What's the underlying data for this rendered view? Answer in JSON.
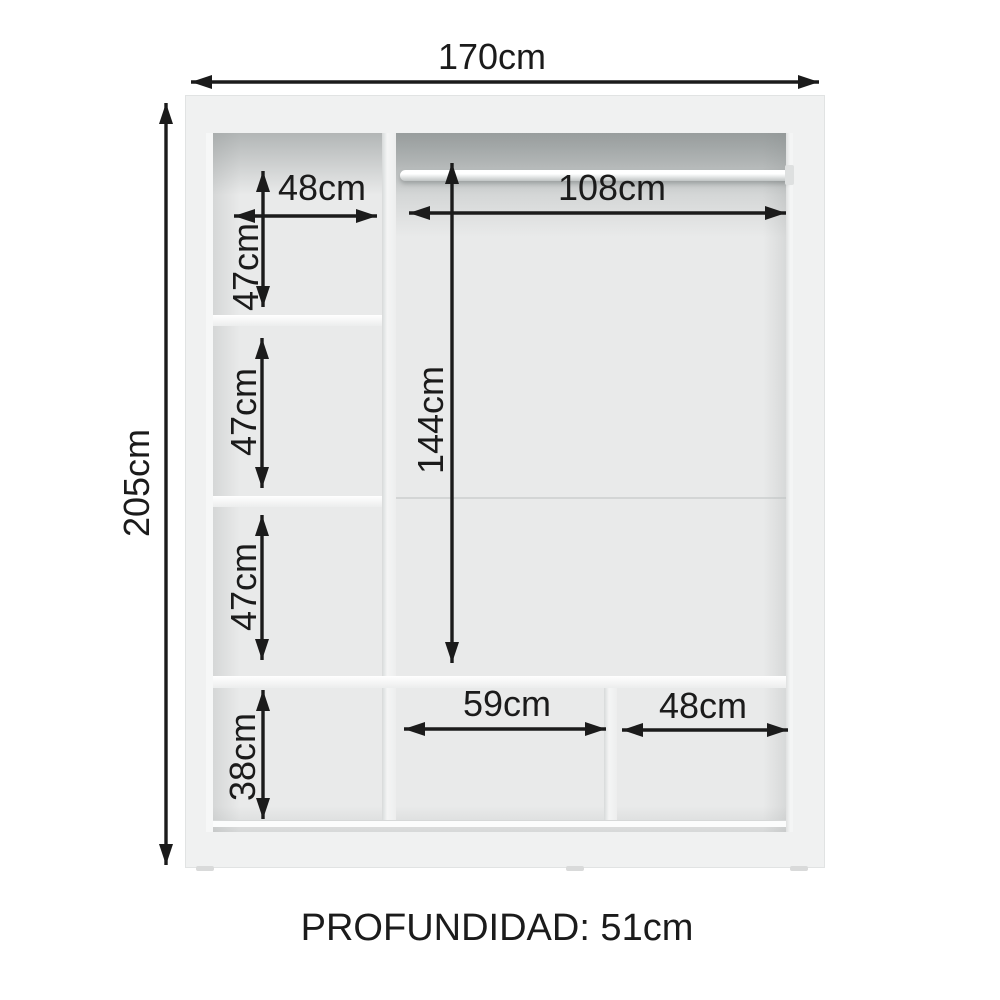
{
  "diagram": {
    "type": "wardrobe-interior-dimension-diagram",
    "labels": {
      "total_width": "170cm",
      "total_height": "205cm",
      "left_column_width": "48cm",
      "left_compartment_1_height": "47cm",
      "left_compartment_2_height": "47cm",
      "left_compartment_3_height": "47cm",
      "bottom_left_height": "38cm",
      "hanging_area_width": "108cm",
      "hanging_area_height": "144cm",
      "bottom_middle_width": "59cm",
      "bottom_right_width": "48cm"
    },
    "footer": {
      "depth": "PROFUNDIDAD: 51cm"
    },
    "colors": {
      "annotation": "#1b1b1b",
      "cabinet_body": "#f0f1f1",
      "cabinet_interior": "#e9eaea",
      "background": "#ffffff"
    }
  }
}
